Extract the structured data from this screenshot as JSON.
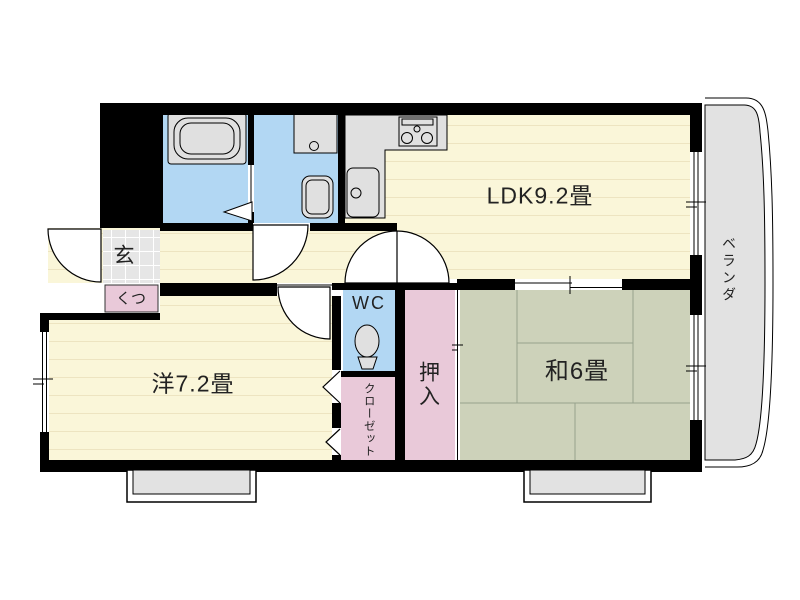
{
  "plan": {
    "title": "1LDK apartment floor plan",
    "rooms": {
      "ldk": "LDK9.2畳",
      "western": "洋7.2畳",
      "japanese": "和6畳",
      "wc": "WC",
      "oshiire": "押入",
      "closet": "クローゼット",
      "veranda": "ベランダ",
      "genkan": "玄",
      "shoes": "くつ"
    },
    "colors": {
      "wall": "#000000",
      "floor": "#FAF6D9",
      "floor-line": "#EDE4C1",
      "water": "#B2D7F3",
      "pink": "#E9C9D9",
      "tatami": "#CDD2BA",
      "tatami-line": "#97A28C",
      "fixture": "#E0E0E0",
      "outdoor": "#E2E2E2",
      "text": "#222222"
    }
  }
}
